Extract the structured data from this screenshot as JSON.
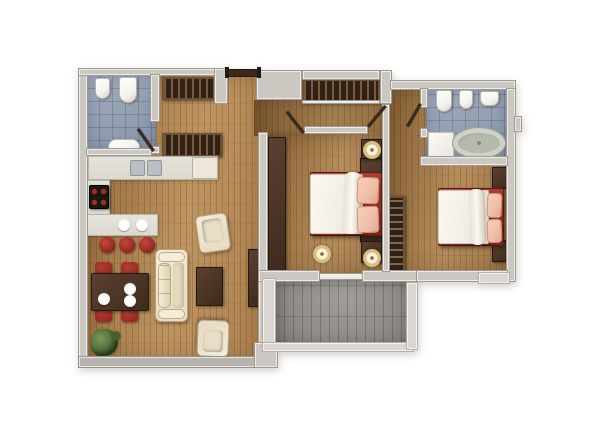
{
  "meta": {
    "scene": "Two-bedroom apartment floor plan, top-down 3D architectural render",
    "width": 600,
    "height": 434,
    "background": "#ffffff",
    "visible_text": "none"
  },
  "rooms": {
    "bathroom_main": {
      "label": "bathroom 1 (top left)",
      "floor": "blue-gray tile",
      "fixtures": [
        "bidet",
        "toilet",
        "washbasin",
        "swing door"
      ]
    },
    "entry_hall": {
      "label": "entry hall",
      "floor": "wood",
      "fixtures": [
        "entrance door",
        "wardrobe closet",
        "wardrobe closet"
      ]
    },
    "kitchen": {
      "label": "kitchen",
      "floor": "wood",
      "fixtures": [
        "counter with double sink",
        "appliance",
        "cooktop with 4 burners",
        "bar counter",
        "2 plates",
        "3 bar stools"
      ]
    },
    "living_dining": {
      "label": "living / dining room",
      "floor": "wood",
      "fixtures": [
        "dining table",
        "4 dining chairs",
        "3 plates",
        "sofa",
        "coffee table",
        "2 armchairs",
        "tv cabinet",
        "plant"
      ]
    },
    "corridor": {
      "label": "corridor",
      "floor": "wood",
      "fixtures": [
        "built-in closet",
        "door to bedroom 1",
        "door to bedroom wing"
      ]
    },
    "bedroom_1": {
      "label": "bedroom 1 (center)",
      "floor": "wood",
      "fixtures": [
        "tall wardrobe",
        "double bed",
        "2 pillows",
        "headboard panel",
        "2 nightstands",
        "2 lamps",
        "round pouf",
        "sliding balcony door"
      ]
    },
    "bathroom_ensuite": {
      "label": "bathroom 2 (top right)",
      "floor": "blue-gray tile",
      "fixtures": [
        "toilet",
        "bidet",
        "washbasin",
        "oval bathtub",
        "shower mat",
        "swing door"
      ]
    },
    "bedroom_2": {
      "label": "bedroom 2 (right)",
      "floor": "wood",
      "fixtures": [
        "open wardrobe with hangers",
        "double bed",
        "2 pillows",
        "2 nightstands"
      ]
    },
    "balcony": {
      "label": "balcony (bottom center)",
      "floor": "gray tile",
      "fixtures": [
        "parapet walls"
      ]
    }
  },
  "colors": {
    "bg": "#ffffff",
    "wall": "#cbc8c2",
    "wall_dark": "#b7b4ae",
    "wall_light": "#dad7d2",
    "wood_dark": "#8e6536",
    "wood_mid": "#aa7f4c",
    "wood_light": "#bf945f",
    "tile_bath": "#96a2b4",
    "tile_balcony": "#908d89",
    "counter": "#dcd9cf",
    "appliance": "#ece7da",
    "dark_wood": "#4a3424",
    "dark_wood_deep": "#2f2117",
    "slat": "#7a5c38",
    "accent_red": "#9b2b24",
    "bed_frame": "#a8392f",
    "cream": "#e8dec5",
    "cream_light": "#f4edda",
    "duvet": "#f2efe6",
    "pillow": "#eebfa8",
    "pillow_edge": "#d98f74",
    "lamp_ring": "#d8bd7d",
    "lamp_inner": "#f8f0d8",
    "lamp_dot": "#7a6a3d",
    "fixture": "#f4f4ee",
    "fixture_edge": "#b5b5aa",
    "tub_rim": "#cdd1c6",
    "tub_inner": "#b5baad",
    "stove": "#1b1713",
    "burner": "#a32b20",
    "plant_a": "#7a9a57",
    "plant_b": "#43602f",
    "door_wood": "#3a2a1c",
    "balcony_door": "#e8e6e0"
  }
}
